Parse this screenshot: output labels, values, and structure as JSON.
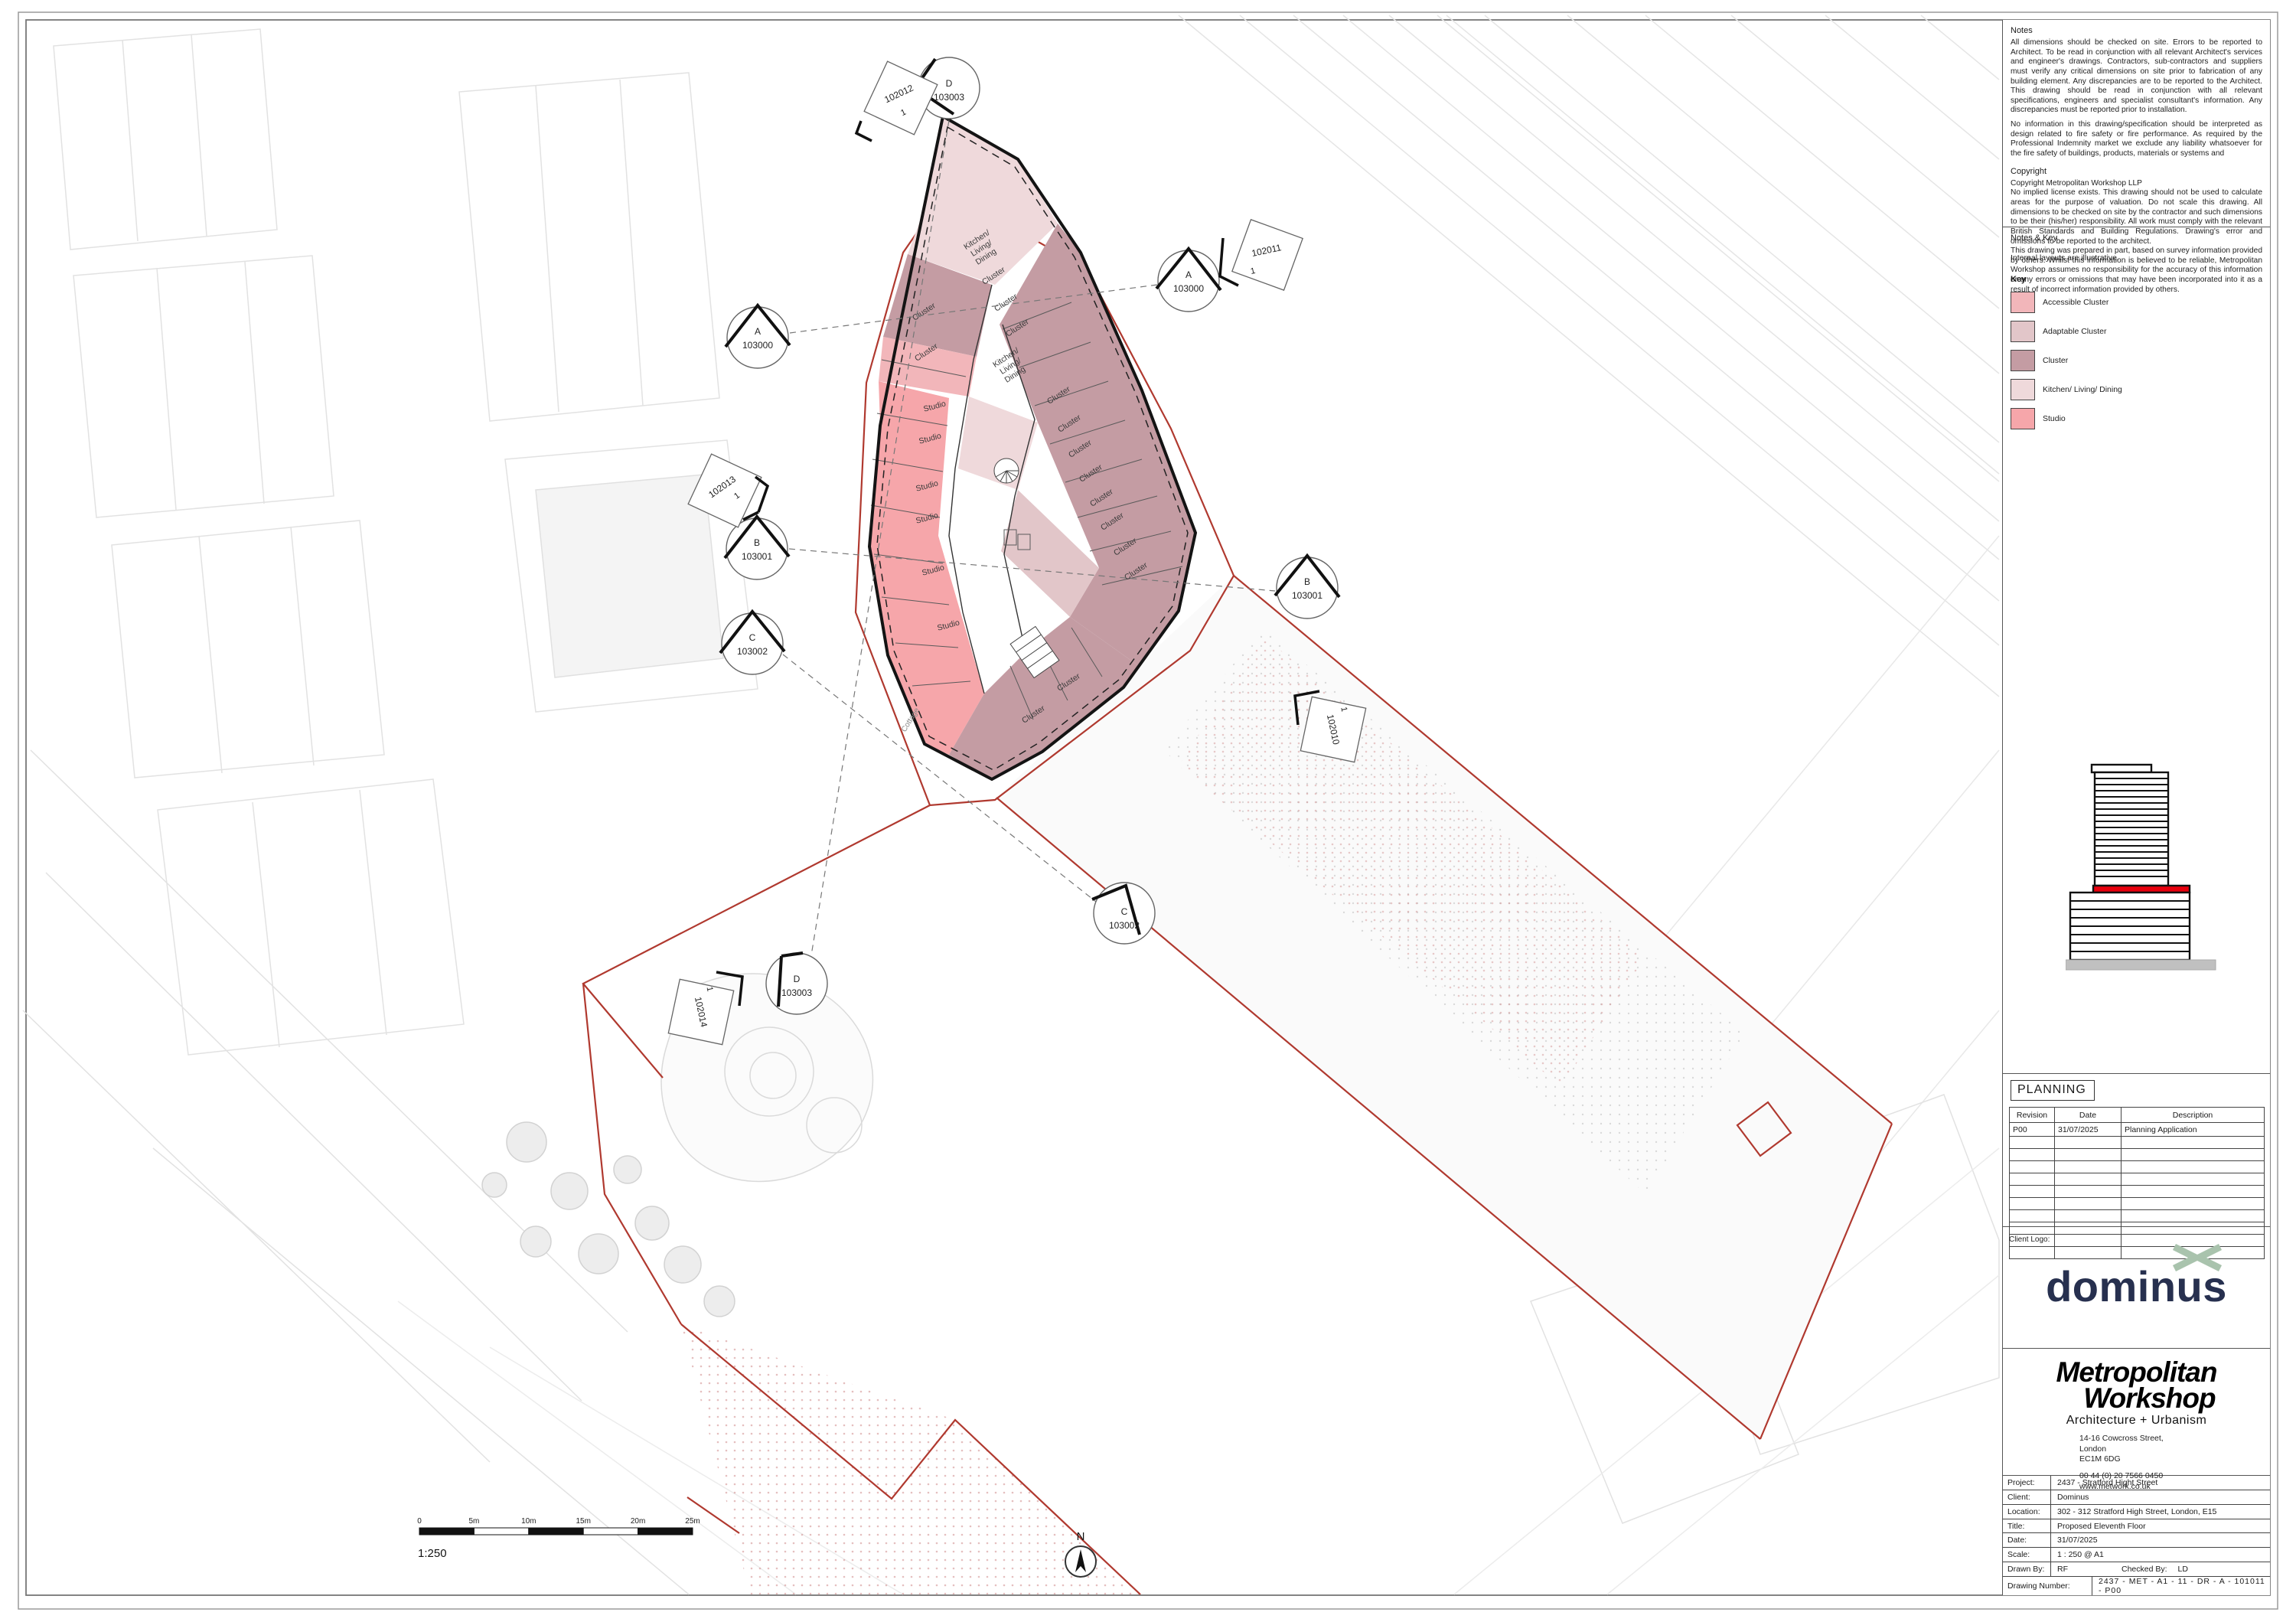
{
  "colors": {
    "boundary_red": "#b0392f",
    "basemap_grey": "#e2e2e2",
    "wall_black": "#141414",
    "dominus_navy": "#27304f",
    "dominus_green": "#a9c3ad",
    "building_icon_red": "#e8000d",
    "building_icon_base_grey": "#c0c0c0"
  },
  "title_block": {
    "notes": {
      "heading": "Notes",
      "para1": "All dimensions should be checked on site. Errors to be reported to Architect. To be read in conjunction with all relevant Architect's services and engineer's drawings. Contractors, sub-contractors and suppliers must verify any critical dimensions on site prior to fabrication of any building element. Any discrepancies are to be reported to the Architect. This drawing should be read in conjunction with all relevant specifications, engineers and specialist consultant's information. Any discrepancies must be reported prior to installation.",
      "para2": "No information in this drawing/specification should be interpreted as design related to fire safety or fire performance. As required by the Professional Indemnity market we exclude any liability whatsoever for the fire safety of buildings, products, materials or systems and"
    },
    "copyright": {
      "heading": "Copyright",
      "line1": "Copyright Metropolitan Workshop LLP",
      "para1": "No implied license exists. This drawing should not be used to calculate areas for the purpose of valuation. Do not scale this drawing. All dimensions to be checked on site by the contractor and such dimensions to be their (his/her) responsibility. All work must comply with the relevant British Standards and Building Regulations. Drawing's error and omissions to be reported to the architect.",
      "para2": "This drawing was prepared in part, based on survey information provided by others. Whilst this information is believed to be reliable, Metropolitan Workshop assumes no responsibility for the accuracy of this information or any errors or omissions that may have been incorporated into it as a result of incorrect information provided by others."
    },
    "notes_key": {
      "heading": "Notes & Key",
      "note": "Internal layouts are illustrative.",
      "key_heading": "Key",
      "items": [
        {
          "label": "Accessible Cluster",
          "color": "#F2B6BA"
        },
        {
          "label": "Adaptable Cluster",
          "color": "#E2C6C9"
        },
        {
          "label": "Cluster",
          "color": "#C49CA3"
        },
        {
          "label": "Kitchen/ Living/ Dining",
          "color": "#EFD9DB"
        },
        {
          "label": "Studio",
          "color": "#F6A6AA"
        }
      ]
    },
    "planning_label": "PLANNING",
    "revision_table": {
      "headers": [
        "Revision",
        "Date",
        "Description"
      ],
      "row1": {
        "revision": "P00",
        "date": "31/07/2025",
        "description": "Planning Application"
      }
    },
    "client_logo_label": "Client Logo:",
    "client_logo_text": "dominus",
    "architect": {
      "logo_line1": "Metropolitan",
      "logo_line2": "Workshop",
      "tagline": "Architecture + Urbanism",
      "address1": "14-16 Cowcross Street,",
      "address2": "London",
      "address3": "EC1M 6DG",
      "phone": "00 44 (0) 20 7566 0450",
      "website": "www.metwork.co.uk"
    },
    "project_info": {
      "project_label": "Project:",
      "project": "2437 - Stratford Hight Street",
      "client_label": "Client:",
      "client": "Dominus",
      "location_label": "Location:",
      "location": "302 - 312 Stratford High Street, London, E15",
      "title_label": "Title:",
      "title": "Proposed Eleventh Floor",
      "date_label": "Date:",
      "date": "31/07/2025",
      "scale_label": "Scale:",
      "scale": "1 : 250 @ A1",
      "drawn_by_label": "Drawn By:",
      "drawn_by": "RF",
      "checked_by_label": "Checked By:",
      "checked_by": "LD",
      "drawing_number_label": "Drawing Number:",
      "drawing_number": "2437 - MET - A1 - 11 - DR - A - 101011 - P00"
    }
  },
  "drawing": {
    "scale_bar": {
      "labels": [
        "0",
        "5m",
        "10m",
        "15m",
        "20m",
        "25m"
      ],
      "ratio": "1:250"
    },
    "north_label": "N",
    "markers": {
      "sections": [
        {
          "ref": "A",
          "num": "103000"
        },
        {
          "ref": "B",
          "num": "103001"
        },
        {
          "ref": "C",
          "num": "103002"
        },
        {
          "ref": "D",
          "num": "103003"
        }
      ],
      "details": [
        {
          "num": "102012",
          "sub": "1"
        },
        {
          "num": "102013",
          "sub": "1"
        },
        {
          "num": "102011",
          "sub": "1"
        },
        {
          "num": "102010",
          "sub": "1"
        },
        {
          "num": "102014",
          "sub": "1"
        }
      ]
    },
    "plan_labels": {
      "cluster": "Cluster",
      "studio": "Studio",
      "kld1": "Kitchen/",
      "kld2": "Living/",
      "kld3": "Dining",
      "cottage": "Cottage"
    }
  }
}
